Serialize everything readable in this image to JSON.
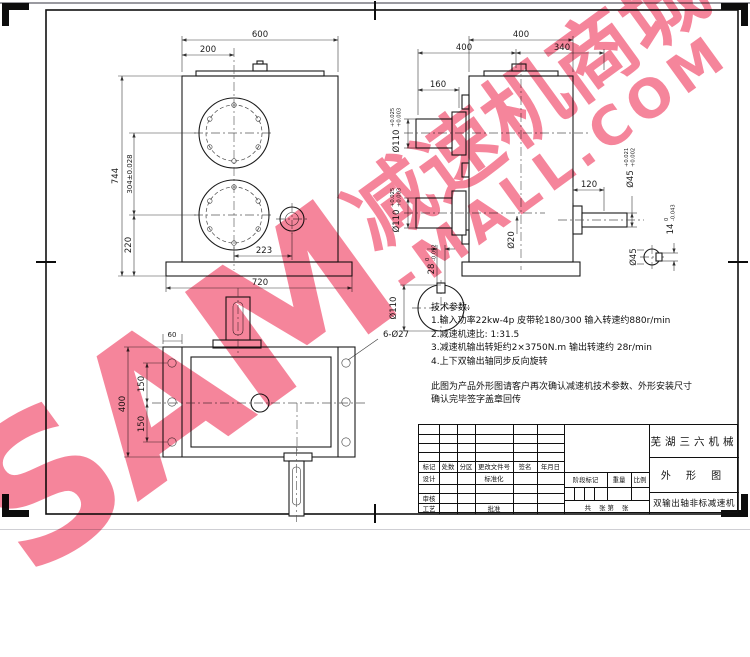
{
  "watermark": {
    "brand": "SAM",
    "line1": "减速机商城",
    "line2": "-MALL.COM",
    "color": "#ee2c52"
  },
  "front_view": {
    "width": "600",
    "hub_offset": "200",
    "total_height": "744",
    "center_distance": "304±0.028",
    "base_offset": "220",
    "shaft_offset": "223",
    "base_width": "720"
  },
  "side_view": {
    "top_width": "400",
    "left_span": "400",
    "right_span": "340",
    "shaft_length": "160",
    "out_shaft_length": "120",
    "upper_bore": {
      "nominal": "Ø110",
      "tol_upper": "+0.025",
      "tol_lower": "+0.003"
    },
    "lower_bore": {
      "nominal": "Ø110",
      "tol_upper": "+0.025",
      "tol_lower": "+0.003"
    },
    "out_shaft_dia": {
      "nominal": "Ø45",
      "tol_upper": "+0.021",
      "tol_lower": "+0.002"
    },
    "center_hole": "Ø20",
    "out_key": {
      "nominal": "14",
      "tol_upper": "0",
      "tol_lower": "-0.043"
    },
    "out_section_dia": "Ø45",
    "main_key": {
      "nominal": "28",
      "tol_upper": "0",
      "tol_lower": "-0.052"
    },
    "main_section_dia": "Ø110"
  },
  "bottom_view": {
    "flange_width": "60",
    "plate_height": "400",
    "hole_pitch_a": "150",
    "hole_pitch_b": "150",
    "holes_label": "6-Ø27"
  },
  "notes": {
    "heading": "技术参数:",
    "line1": "1.输入功率22kw-4p  皮带轮180/300  输入转速约880r/min",
    "line2": "2.减速机速比: 1:31.5",
    "line3": "3.减速机输出转矩约2×3750N.m  输出转速约 28r/min",
    "line4": "4.上下双输出轴同步反向旋转",
    "para1": "此图为产品外形图请客户再次确认减速机技术参数、外形安装尺寸",
    "para2": "确认完毕签字盖章回传"
  },
  "title_block": {
    "company": "芜湖三六机械",
    "drawing_title": "外 形 图",
    "part_name": "双输出轴非标减速机",
    "h_mark": "标记",
    "h_count": "处数",
    "h_zone": "分区",
    "h_doc": "更改文件号",
    "h_sign": "签名",
    "h_date": "年月日",
    "design": "设计",
    "standardize": "标准化",
    "review": "审核",
    "process": "工艺",
    "approve": "批准",
    "stage_mark": "阶段标记",
    "weight": "重量",
    "scale": "比例",
    "sheet": "共    张 第    张"
  }
}
